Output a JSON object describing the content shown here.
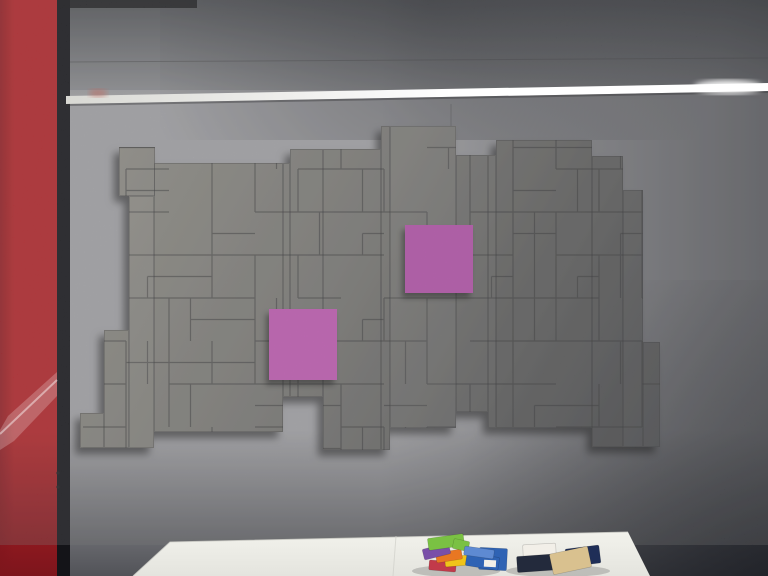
{
  "meta": {
    "scene_label": "Showroom wall of gray acoustic felt tiles arranged like pixel blocks with two magenta accent squares, red panel at left, LED light rail, and white table with felt samples",
    "canvas": {
      "width": 768,
      "height": 576
    }
  },
  "palette": {
    "wall_base": "#aeaeb2",
    "wall_shadow_dark": "#14161c",
    "red_panel": "#c02429",
    "red_panel_dark": "#7d151c",
    "gap_shadow": "#141418",
    "rail_start": "#d9d9d4",
    "rail_end": "#ffffff",
    "rail_reflection": "#c06a60",
    "mosaic_light": "#9c9a92",
    "mosaic_mid": "#807f7b",
    "mosaic_dark": "#4d4e51",
    "seam": "#323234",
    "magenta_upper": "#c155b7",
    "magenta_lower": "#ce5fc0",
    "table_top": "#f2f2ec",
    "table_bottom": "#e4e4de",
    "table_seam": "#cfcfc9",
    "swatch_green": "#7ac143",
    "swatch_purple": "#7a4fa8",
    "swatch_orange": "#e87722",
    "swatch_yellow": "#f0c419",
    "swatch_red": "#c23a4a",
    "swatch_blue": "#2f63b4",
    "swatch_blue_light": "#5e8ad2",
    "wallet_navy": "#232a3c",
    "card_tan": "#d9c18f",
    "folder_navy": "#1f2e57",
    "box_white": "#f2efe8",
    "plastic_film": "#ffffff"
  },
  "wall": {
    "seam_y": 62,
    "vertical_seam": {
      "x": 451,
      "y1": 104,
      "y2": 152
    },
    "rail": {
      "x_start": 66,
      "y_left": 96,
      "y_right": 83,
      "thickness": 8,
      "glow_x": 728,
      "glow_y": 87
    },
    "reflection": {
      "cx": 98,
      "cy": 93,
      "rx": 9,
      "ry": 4
    }
  },
  "red_panel": {
    "x": 0,
    "y": 0,
    "w": 57,
    "h": 576,
    "screws": [
      [
        58,
        473
      ],
      [
        58,
        487
      ]
    ],
    "film_polygon": [
      [
        0,
        430
      ],
      [
        8,
        416
      ],
      [
        57,
        372
      ],
      [
        57,
        396
      ],
      [
        14,
        441
      ],
      [
        0,
        450
      ]
    ],
    "film_streak": [
      [
        0,
        434
      ],
      [
        57,
        380
      ]
    ]
  },
  "gap": {
    "x": 57,
    "w": 13,
    "h": 576
  },
  "top_shadow": {
    "x": 57,
    "w": 140,
    "h": 8
  },
  "mosaic": {
    "bbox": [
      80,
      126,
      660,
      450
    ],
    "blocks": [
      [
        119,
        147,
        36,
        49
      ],
      [
        80,
        413,
        24,
        35
      ],
      [
        104,
        330,
        25,
        118
      ],
      [
        129,
        196,
        25,
        252
      ],
      [
        154,
        163,
        129,
        269
      ],
      [
        283,
        163,
        7,
        234
      ],
      [
        290,
        149,
        33,
        248
      ],
      [
        323,
        149,
        58,
        301
      ],
      [
        381,
        126,
        9,
        324
      ],
      [
        390,
        126,
        66,
        302
      ],
      [
        456,
        155,
        32,
        257
      ],
      [
        488,
        155,
        8,
        273
      ],
      [
        496,
        140,
        96,
        288
      ],
      [
        592,
        156,
        31,
        291
      ],
      [
        623,
        190,
        20,
        257
      ],
      [
        643,
        342,
        17,
        105
      ]
    ],
    "grid": {
      "origin": [
        83,
        126
      ],
      "cell": 43,
      "seed": 7
    }
  },
  "magenta_panels": [
    {
      "name": "magenta-panel-upper",
      "x": 405,
      "y": 225,
      "w": 68,
      "h": 68,
      "color": "magenta_upper"
    },
    {
      "name": "magenta-panel-lower",
      "x": 269,
      "y": 309,
      "w": 68,
      "h": 71,
      "color": "magenta_lower"
    }
  ],
  "table": {
    "polygon": [
      [
        133,
        576
      ],
      [
        170,
        542
      ],
      [
        628,
        532
      ],
      [
        650,
        576
      ]
    ],
    "seam": {
      "x_top": 396,
      "y_top": 536,
      "x_bottom": 393,
      "y_bottom": 576
    },
    "shadows": [
      {
        "cx": 456,
        "cy": 571,
        "rx": 44,
        "ry": 6
      },
      {
        "cx": 558,
        "cy": 571,
        "rx": 52,
        "ry": 6
      }
    ],
    "objects": [
      {
        "name": "white-box",
        "x": 523,
        "y": 544,
        "w": 33,
        "h": 15,
        "rot": -3,
        "color": "box_white"
      },
      {
        "name": "navy-folder",
        "x": 566,
        "y": 547,
        "w": 34,
        "h": 18,
        "rot": -7,
        "color": "folder_navy"
      },
      {
        "name": "navy-wallet",
        "x": 517,
        "y": 555,
        "w": 45,
        "h": 16,
        "rot": -4,
        "color": "wallet_navy"
      },
      {
        "name": "tan-card-stack",
        "x": 551,
        "y": 550,
        "w": 39,
        "h": 21,
        "rot": -12,
        "color": "card_tan"
      },
      {
        "name": "blue-card-stack",
        "x": 479,
        "y": 548,
        "w": 28,
        "h": 22,
        "rot": 3,
        "color": "swatch_blue"
      },
      {
        "name": "felt-swatch-red",
        "x": 429,
        "y": 561,
        "w": 27,
        "h": 10,
        "rot": 5,
        "color": "swatch_red"
      },
      {
        "name": "felt-swatch-yellow",
        "x": 445,
        "y": 556,
        "w": 24,
        "h": 10,
        "rot": -5,
        "color": "swatch_yellow"
      },
      {
        "name": "felt-swatch-orange",
        "x": 436,
        "y": 551,
        "w": 26,
        "h": 10,
        "rot": -9,
        "color": "swatch_orange"
      },
      {
        "name": "felt-swatch-purple",
        "x": 423,
        "y": 546,
        "w": 27,
        "h": 11,
        "rot": -14,
        "color": "swatch_purple"
      },
      {
        "name": "felt-swatch-green",
        "x": 428,
        "y": 536,
        "w": 36,
        "h": 12,
        "rot": -8,
        "color": "swatch_green"
      },
      {
        "name": "felt-swatch-green-small",
        "x": 453,
        "y": 540,
        "w": 16,
        "h": 10,
        "rot": 12,
        "color": "swatch_green"
      },
      {
        "name": "felt-swatch-blue",
        "x": 466,
        "y": 555,
        "w": 33,
        "h": 13,
        "rot": 9,
        "color": "swatch_blue"
      },
      {
        "name": "felt-swatch-blue-light",
        "x": 464,
        "y": 548,
        "w": 30,
        "h": 9,
        "rot": 8,
        "color": "swatch_blue_light"
      }
    ]
  }
}
